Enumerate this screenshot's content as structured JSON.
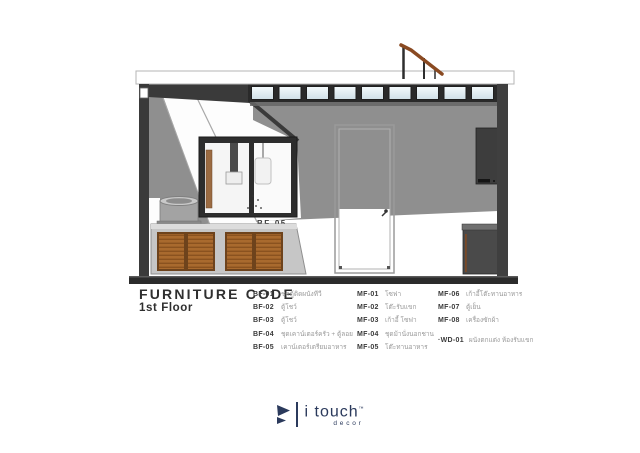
{
  "colors": {
    "brand_navy": "#2b3a5c",
    "wood": "#a96a2e",
    "wall_gray": "#8f8f8f",
    "frame_dark": "#2d2d2d"
  },
  "drawing": {
    "bf05_label": "BF-05"
  },
  "legend": {
    "title": "FURNITURE CODE",
    "subtitle": "1st Floor",
    "col1": [
      {
        "code": "BF-01",
        "desc": "ชุดตู้ติดผนังทีวี"
      },
      {
        "code": "BF-02",
        "desc": "ตู้โชว์"
      },
      {
        "code": "BF-03",
        "desc": "ตู้โชว์"
      },
      {
        "code": "BF-04",
        "desc": "ชุดเคาน์เตอร์ครัว + ตู้ลอย"
      },
      {
        "code": "BF-05",
        "desc": "เคาน์เตอร์เตรียมอาหาร"
      }
    ],
    "col2": [
      {
        "code": "MF-01",
        "desc": "โซฟา"
      },
      {
        "code": "MF-02",
        "desc": "โต๊ะรับแขก"
      },
      {
        "code": "MF-03",
        "desc": "เก้าอี้ โซฟา"
      },
      {
        "code": "MF-04",
        "desc": "ชุดม้านั่งนอกชาน"
      },
      {
        "code": "MF-05",
        "desc": "โต๊ะทานอาหาร"
      }
    ],
    "col3": [
      {
        "code": "MF-06",
        "desc": "เก้าอี้โต๊ะทานอาหาร"
      },
      {
        "code": "MF-07",
        "desc": "ตู้เย็น"
      },
      {
        "code": "MF-08",
        "desc": "เครื่องซักผ้า"
      }
    ],
    "wd": {
      "code": "·WD-01",
      "desc": "ผนังตกแต่ง ห้องรับแขก"
    }
  },
  "footer": {
    "brand": "i touch",
    "tm": "™",
    "sub": "decor"
  }
}
